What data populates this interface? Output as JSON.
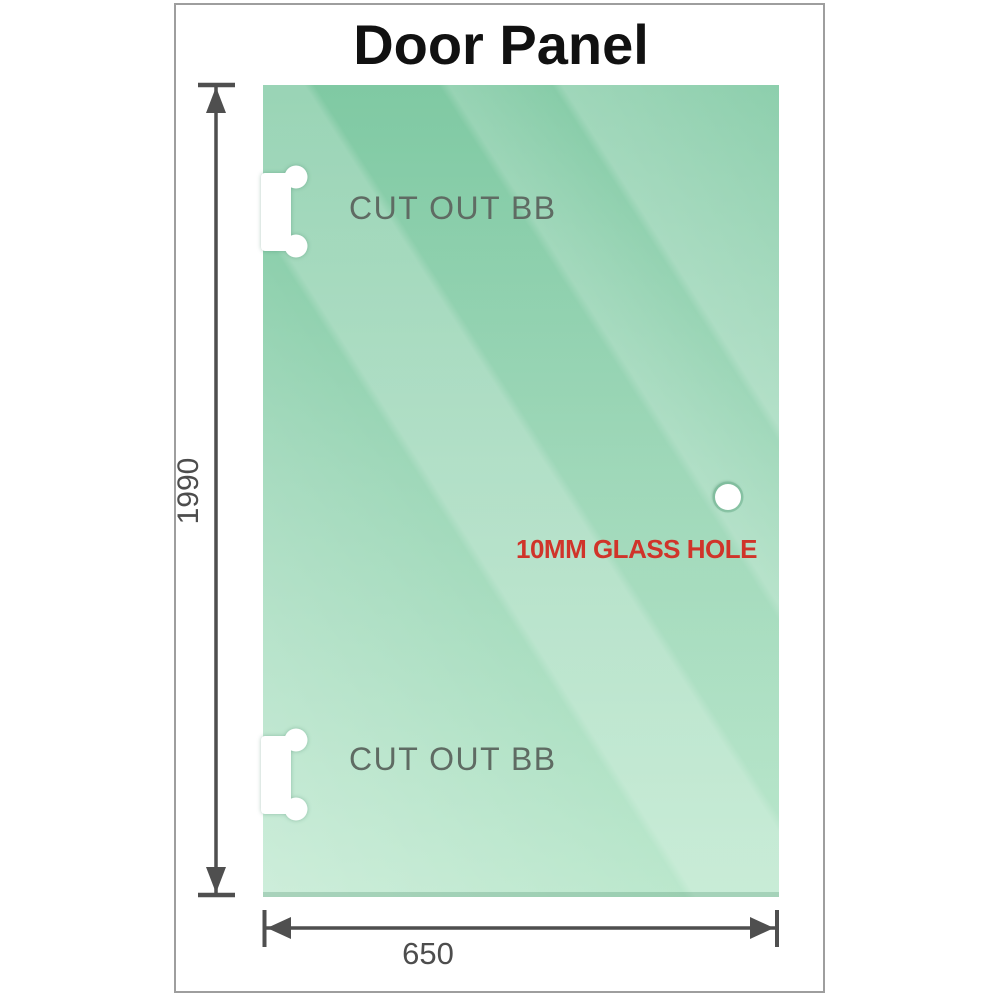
{
  "title": "Door Panel",
  "panel": {
    "hinge_cutouts": [
      {
        "position": "top",
        "label": "CUT OUT BB"
      },
      {
        "position": "bottom",
        "label": "CUT OUT BB"
      }
    ],
    "glass_hole": {
      "label": "10MM GLASS HOLE"
    }
  },
  "dimensions": {
    "height": "1990",
    "width": "650"
  },
  "colors": {
    "glass_top": "#7dc8a1",
    "glass_mid": "#9dd7b8",
    "glass_bottom": "#bae7cc",
    "dimension_lines": "#4f4f4f",
    "dimension_text": "#4d4d4d",
    "cutout_text": "#5f6b63",
    "hole_text": "#d0342a",
    "frame_border": "#9e9e9e",
    "title_text": "#111111",
    "cutout_fill": "#ffffff"
  }
}
